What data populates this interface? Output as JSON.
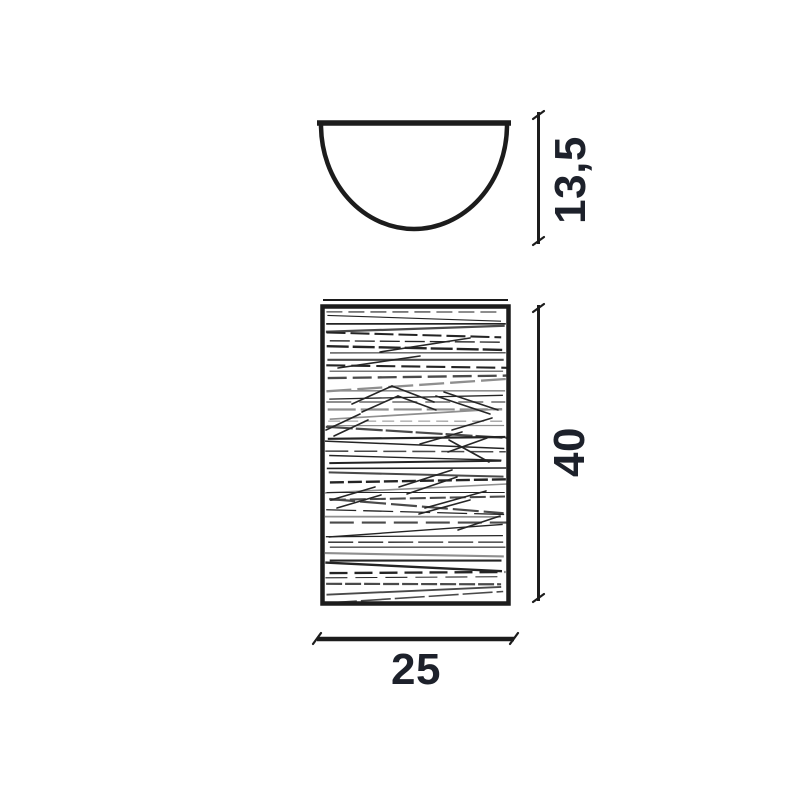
{
  "drawing": {
    "background_color": "#ffffff",
    "ink_color": "#1c1c1c",
    "label_color": "#1d212b",
    "dimensions": {
      "depth": {
        "label": "13,5"
      },
      "height": {
        "label": "40"
      },
      "width": {
        "label": "25"
      }
    }
  }
}
